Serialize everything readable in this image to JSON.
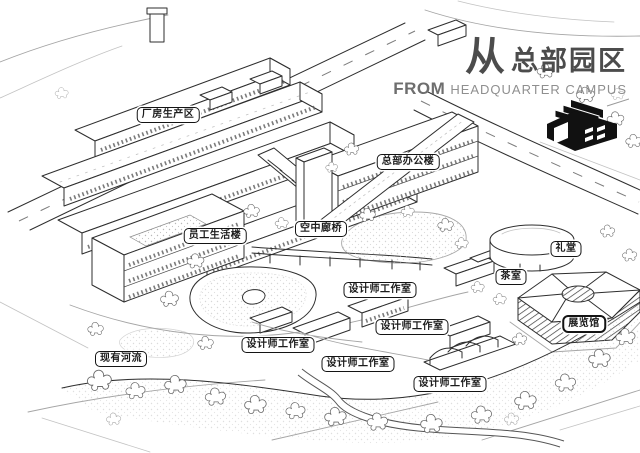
{
  "title": {
    "cn_from": "从",
    "cn_campus": "总部园区",
    "en_from": "FROM",
    "en_campus": "HEADQUARTER CAMPUS"
  },
  "logo_icon": "factory-building-icon",
  "labels": [
    {
      "id": "factory-production-area",
      "text": "厂房生产区"
    },
    {
      "id": "hq-office-building",
      "text": "总部办公楼"
    },
    {
      "id": "sky-bridge",
      "text": "空中廊桥"
    },
    {
      "id": "employee-living-building",
      "text": "员工生活楼"
    },
    {
      "id": "auditorium",
      "text": "礼堂"
    },
    {
      "id": "tea-room",
      "text": "茶室"
    },
    {
      "id": "designer-studio-1",
      "text": "设计师工作室"
    },
    {
      "id": "designer-studio-2",
      "text": "设计师工作室"
    },
    {
      "id": "exhibition-hall",
      "text": "展览馆",
      "emphasis": true
    },
    {
      "id": "designer-studio-3",
      "text": "设计师工作室"
    },
    {
      "id": "existing-river",
      "text": "现有河流"
    },
    {
      "id": "designer-studio-4",
      "text": "设计师工作室"
    },
    {
      "id": "designer-studio-5",
      "text": "设计师工作室"
    }
  ],
  "colors": {
    "ink": "#2e2e2e",
    "paper": "#ffffff",
    "title_gray": "#4c4c4c",
    "title_mid_gray": "#6e6e6e",
    "title_light_gray": "#8f8f8f",
    "label_border": "#141414"
  }
}
